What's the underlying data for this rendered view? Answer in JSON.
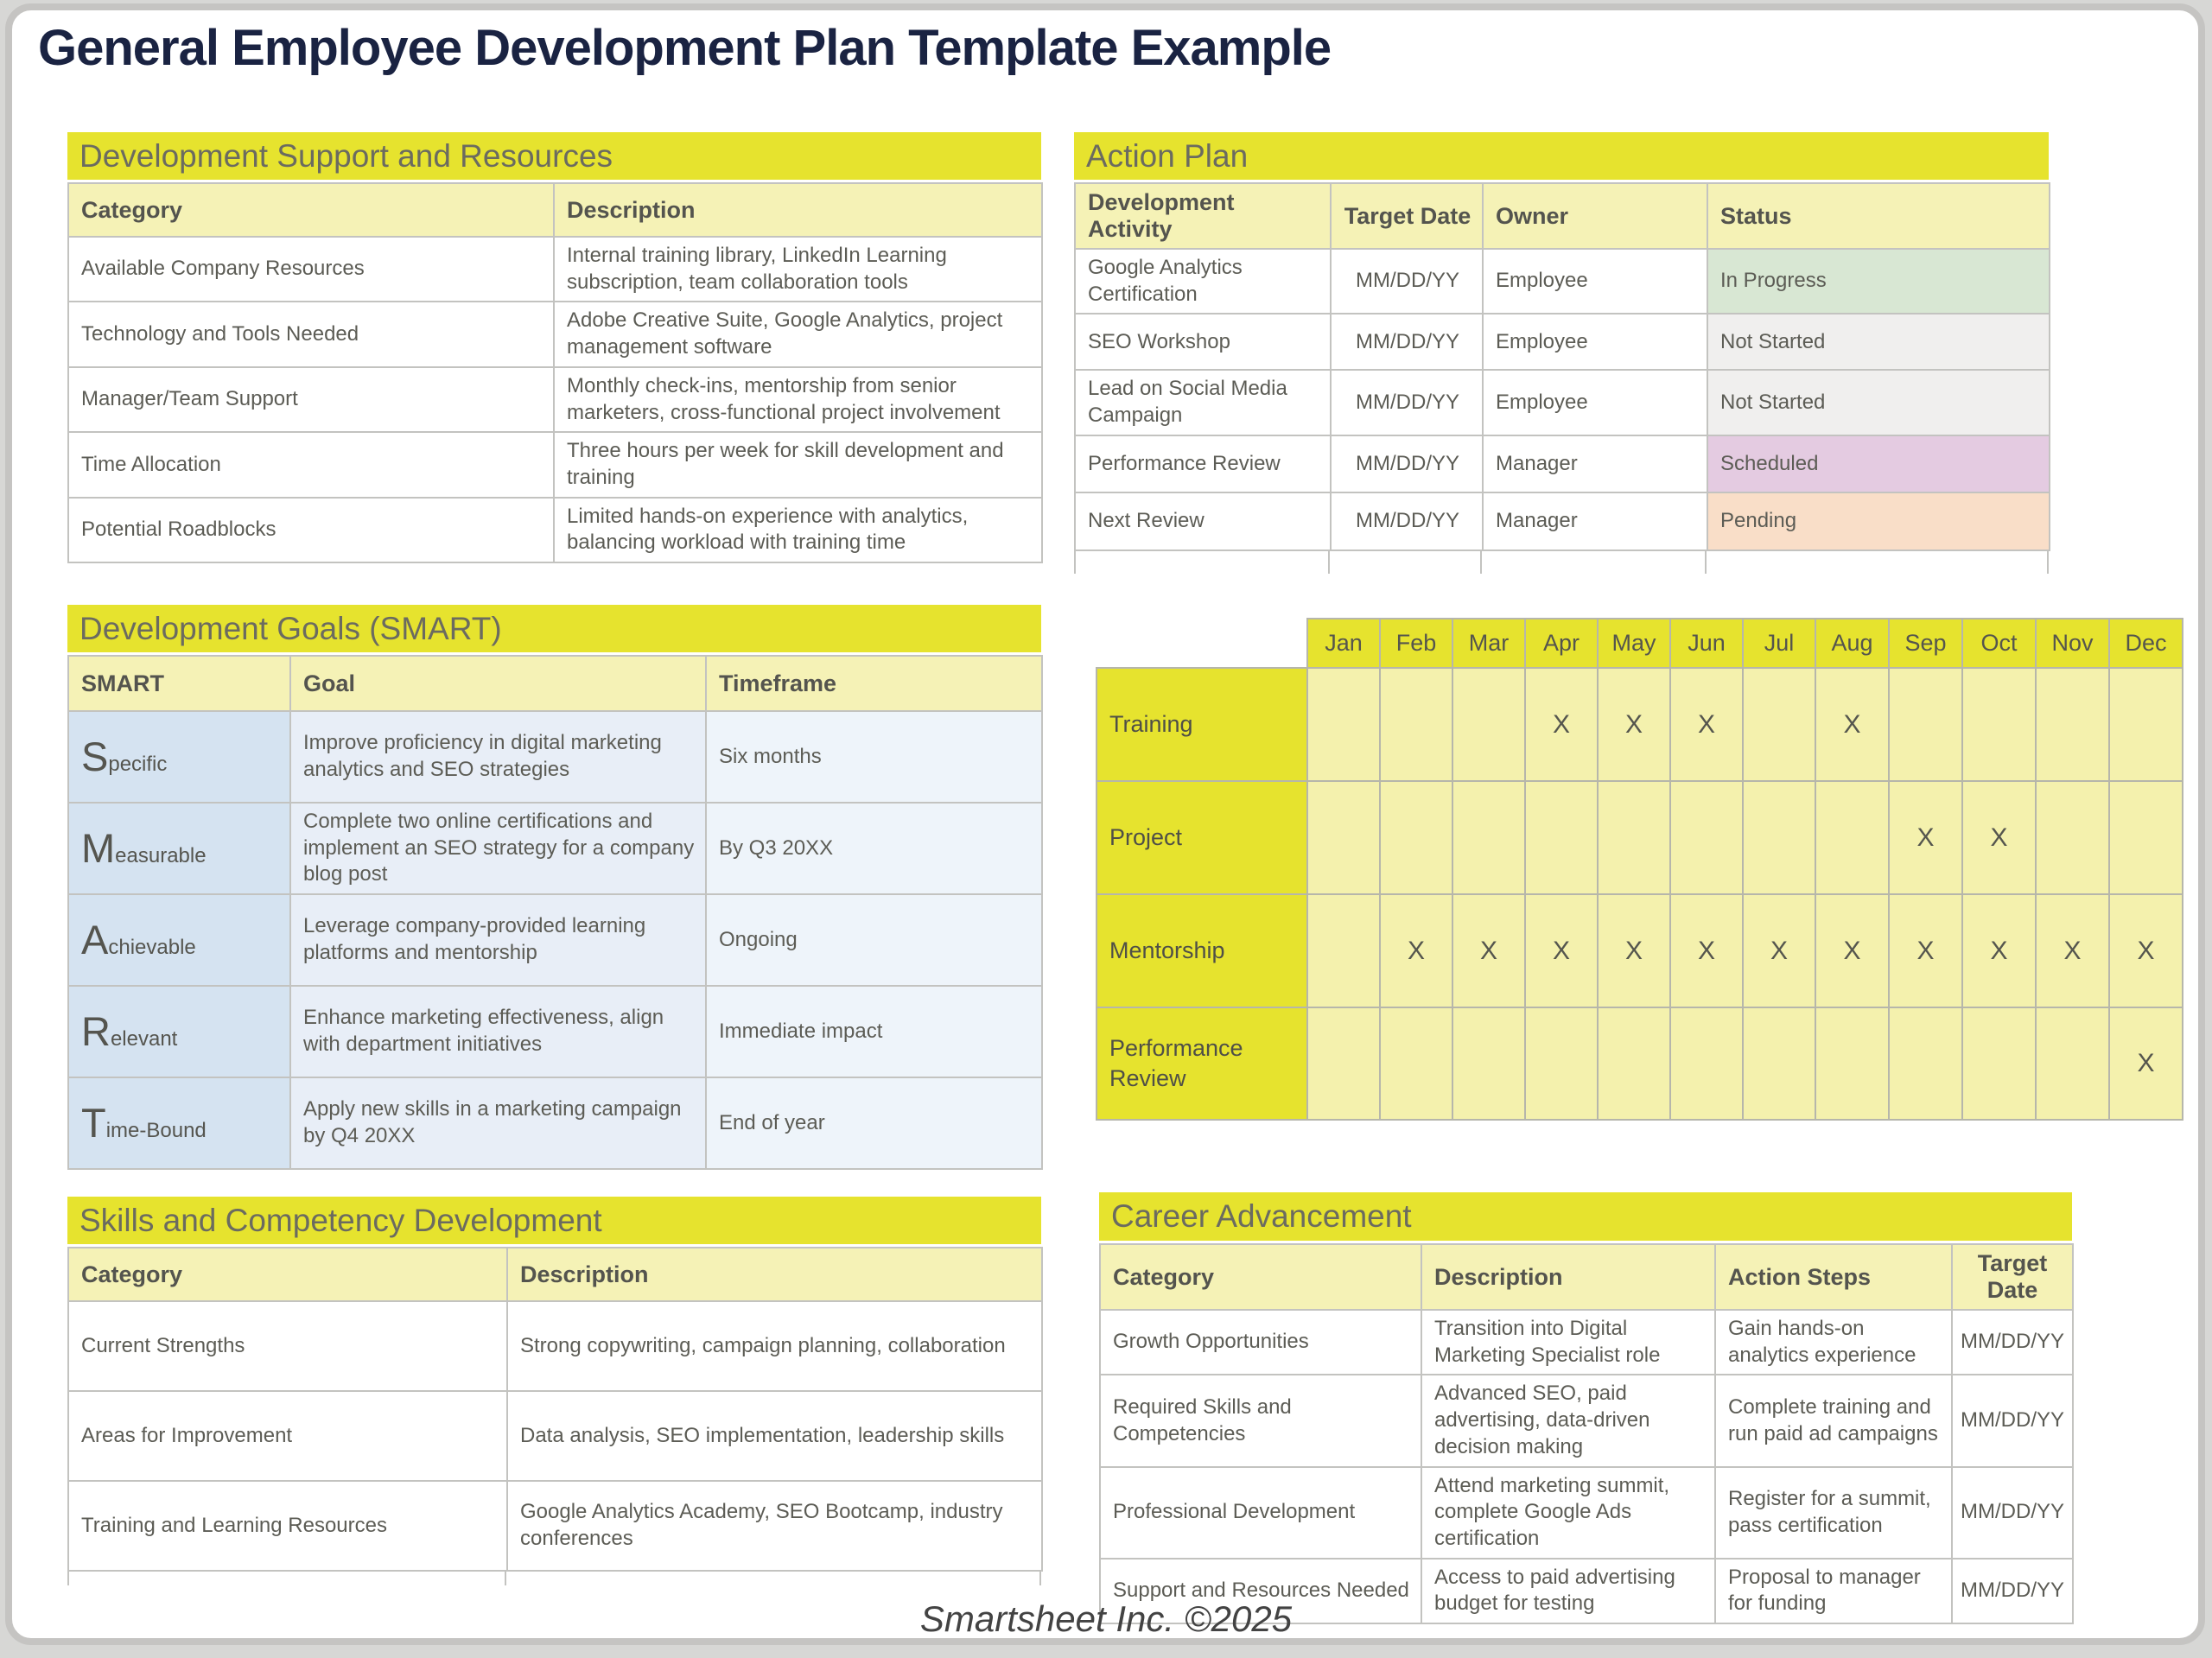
{
  "page": {
    "title": "General Employee Development Plan Template Example",
    "footer": "Smartsheet Inc. ©2025"
  },
  "colors": {
    "accent_yellow": "#e6e32e",
    "header_light_yellow": "#f5f2b6",
    "grid_cell_yellow": "#f4f1ad",
    "title_navy": "#1a2342",
    "body_text_gray": "#5c5c55",
    "status_in_progress_bg": "#d8e7d3",
    "status_not_started_bg": "#f0efee",
    "status_scheduled_bg": "#e4cbe1",
    "status_pending_bg": "#f9dec8",
    "smart_label_blue": "#d5e3f1",
    "smart_goal_blue": "#e8eef7",
    "smart_timeframe_blue": "#eef4fa"
  },
  "support_table": {
    "title": "Development Support and Resources",
    "headers": [
      "Category",
      "Description"
    ],
    "rows": [
      [
        "Available Company Resources",
        "Internal training library, LinkedIn Learning subscription, team collaboration tools"
      ],
      [
        "Technology and Tools Needed",
        "Adobe Creative Suite, Google Analytics, project management software"
      ],
      [
        "Manager/Team Support",
        "Monthly check-ins, mentorship from senior marketers, cross-functional project involvement"
      ],
      [
        "Time Allocation",
        "Three hours per week for skill development and training"
      ],
      [
        "Potential Roadblocks",
        "Limited hands-on experience with analytics, balancing workload with training time"
      ]
    ]
  },
  "action_plan": {
    "title": "Action Plan",
    "headers": [
      "Development Activity",
      "Target Date",
      "Owner",
      "Status"
    ],
    "rows": [
      {
        "activity": "Google Analytics Certification",
        "target_date": "MM/DD/YY",
        "owner": "Employee",
        "status": "In Progress"
      },
      {
        "activity": "SEO Workshop",
        "target_date": "MM/DD/YY",
        "owner": "Employee",
        "status": "Not Started"
      },
      {
        "activity": "Lead on Social Media Campaign",
        "target_date": "MM/DD/YY",
        "owner": "Employee",
        "status": "Not Started"
      },
      {
        "activity": "Performance Review",
        "target_date": "MM/DD/YY",
        "owner": "Manager",
        "status": "Scheduled"
      },
      {
        "activity": "Next Review",
        "target_date": "MM/DD/YY",
        "owner": "Manager",
        "status": "Pending"
      }
    ]
  },
  "smart_goals": {
    "title": "Development Goals (SMART)",
    "headers": [
      "SMART",
      "Goal",
      "Timeframe"
    ],
    "rows": [
      {
        "lead": "S",
        "rest": "pecific",
        "goal": "Improve proficiency in digital marketing analytics and SEO strategies",
        "timeframe": "Six months"
      },
      {
        "lead": "M",
        "rest": "easurable",
        "goal": "Complete two online certifications and implement an SEO strategy for a company blog post",
        "timeframe": "By Q3 20XX"
      },
      {
        "lead": "A",
        "rest": "chievable",
        "goal": "Leverage company-provided learning platforms and mentorship",
        "timeframe": "Ongoing"
      },
      {
        "lead": "R",
        "rest": "elevant",
        "goal": "Enhance marketing effectiveness, align with department initiatives",
        "timeframe": "Immediate impact"
      },
      {
        "lead": "T",
        "rest": "ime-Bound",
        "goal": "Apply new skills in a marketing campaign by Q4 20XX",
        "timeframe": "End of year"
      }
    ]
  },
  "schedule_grid": {
    "months": [
      "Jan",
      "Feb",
      "Mar",
      "Apr",
      "May",
      "Jun",
      "Jul",
      "Aug",
      "Sep",
      "Oct",
      "Nov",
      "Dec"
    ],
    "rows": [
      {
        "label": "Training",
        "marks": [
          "",
          "",
          "",
          "X",
          "X",
          "X",
          "",
          "X",
          "",
          "",
          "",
          ""
        ]
      },
      {
        "label": "Project",
        "marks": [
          "",
          "",
          "",
          "",
          "",
          "",
          "",
          "",
          "X",
          "X",
          "",
          ""
        ]
      },
      {
        "label": "Mentorship",
        "marks": [
          "",
          "X",
          "X",
          "X",
          "X",
          "X",
          "X",
          "X",
          "X",
          "X",
          "X",
          "X"
        ]
      },
      {
        "label": "Performance Review",
        "marks": [
          "",
          "",
          "",
          "",
          "",
          "",
          "",
          "",
          "",
          "",
          "",
          "X"
        ]
      }
    ]
  },
  "skills_table": {
    "title": "Skills and Competency Development",
    "headers": [
      "Category",
      "Description"
    ],
    "rows": [
      [
        "Current Strengths",
        "Strong copywriting, campaign planning, collaboration"
      ],
      [
        "Areas for Improvement",
        "Data analysis, SEO implementation, leadership skills"
      ],
      [
        "Training and Learning Resources",
        "Google Analytics Academy, SEO Bootcamp, industry conferences"
      ]
    ]
  },
  "career_table": {
    "title": "Career Advancement",
    "headers": [
      "Category",
      "Description",
      "Action Steps",
      "Target Date"
    ],
    "rows": [
      {
        "category": "Growth Opportunities",
        "description": "Transition into Digital Marketing Specialist role",
        "action_steps": "Gain hands-on analytics experience",
        "target_date": "MM/DD/YY"
      },
      {
        "category": "Required Skills and Competencies",
        "description": "Advanced SEO, paid advertising, data-driven decision making",
        "action_steps": "Complete training and run paid ad campaigns",
        "target_date": "MM/DD/YY"
      },
      {
        "category": "Professional Development",
        "description": "Attend marketing summit, complete Google Ads certification",
        "action_steps": "Register for a summit, pass certification",
        "target_date": "MM/DD/YY"
      },
      {
        "category": "Support and Resources Needed",
        "description": "Access to paid advertising budget for testing",
        "action_steps": "Proposal to manager for funding",
        "target_date": "MM/DD/YY"
      }
    ]
  }
}
